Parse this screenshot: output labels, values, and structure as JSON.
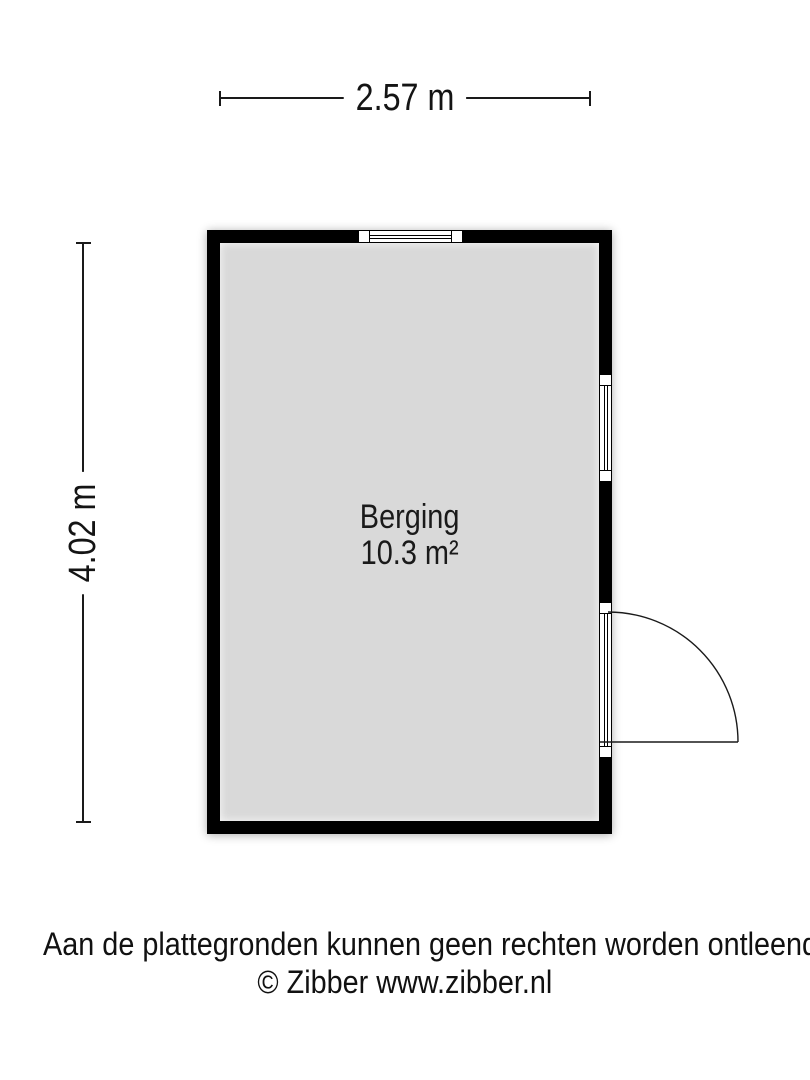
{
  "floor_plan": {
    "width_label": "2.57 m",
    "height_label": "4.02 m",
    "room": {
      "name": "Berging",
      "area": "10.3 m²"
    },
    "features": [
      "window-top",
      "window-right",
      "door-right-with-swing"
    ],
    "colors": {
      "wall": "#000000",
      "floor": "#d9d9d9",
      "background": "#ffffff",
      "lines": "#1a1a1a"
    }
  },
  "footer": {
    "disclaimer": "Aan de plattegronden kunnen geen rechten worden ontleend",
    "copyright": "© Zibber www.zibber.nl"
  }
}
